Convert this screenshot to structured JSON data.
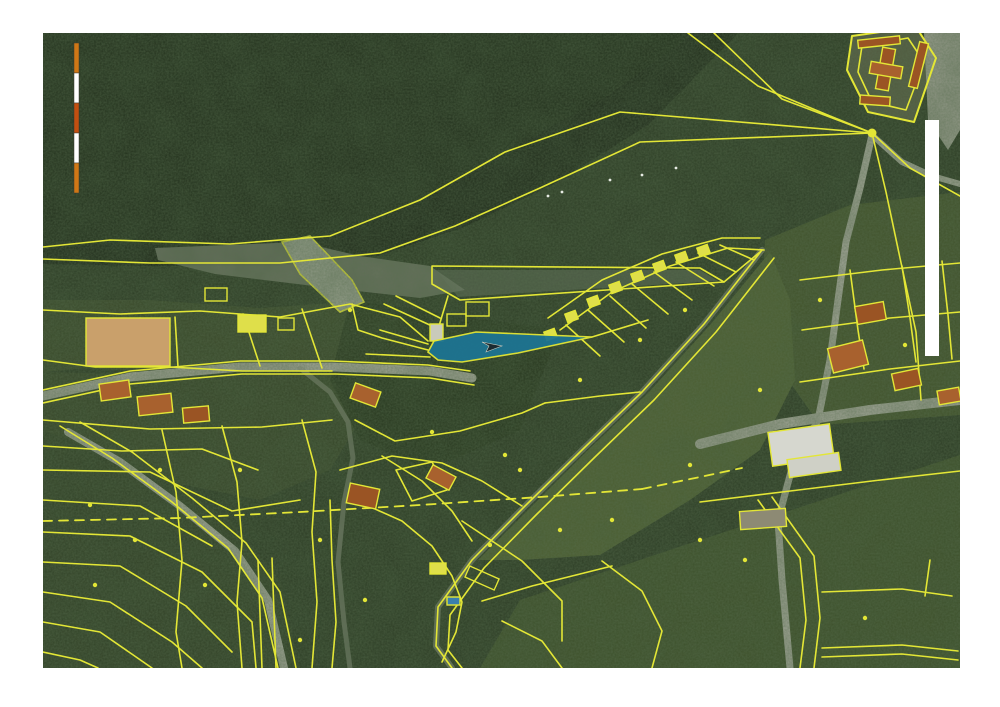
{
  "document": {
    "kind": "scanned cadastral orthophoto map page",
    "page_background": "#ffffff",
    "map_bounds": {
      "x": 43,
      "y": 33,
      "width": 917,
      "height": 635
    }
  },
  "palette": {
    "parcel_line_yellow": "#e3e636",
    "building_yellow": "#dfdf4a",
    "roof_orange": "#a8612e",
    "roof_dark_orange": "#9a5424",
    "tan_field": "#c9a06b",
    "road_gray": "#a5a89a",
    "river_dark": "#1d2818",
    "forest_dark": "#202d1a",
    "forest_base": "#2b3a23",
    "clearing_green": "#3a4929",
    "meadow_bright": "#4d5f31",
    "meadow_mid": "#41522a",
    "gravel_gray": "#7c8471",
    "highlight_blue": "#1d7492",
    "scale_orange": "#cf7716",
    "scale_red_orange": "#c34f10",
    "white": "#ffffff"
  },
  "scale_bar": {
    "x": 74,
    "y": 43,
    "segment_width": 5,
    "segment_height": 30,
    "segment_colors": [
      "#cf7716",
      "#ffffff",
      "#c34f10",
      "#ffffff",
      "#cf7716"
    ]
  },
  "white_bar": {
    "x": 925,
    "y": 120,
    "width": 14,
    "height": 236
  },
  "highlight_parcel": {
    "points": "428,352 434,341 476,332 592,337 518,353 462,362 438,360",
    "fill": "#1d7492",
    "opacity": 0.95,
    "stroke": "#e3e636",
    "marker_points": "482,342 502,346 486,352 489,346",
    "marker_fill": "#1b2a30",
    "marker_stroke": "#cfd0c2"
  },
  "areas": [
    {
      "n": "forest-base",
      "p": "43,33 960,33 960,668 43,668",
      "f": "#2b3a23"
    },
    {
      "n": "forest-dark-north",
      "p": "43,33 695,33 600,100 500,155 410,205 320,240 200,250 100,246 43,250",
      "f": "#202d1a"
    },
    {
      "n": "river",
      "p": "695,33 738,33 648,125 552,185 462,228 378,256 280,266 150,266 43,264 43,250 110,243 210,247 320,238 415,202 505,152 605,97",
      "f": "#1d2818"
    },
    {
      "n": "gravel-bar",
      "p": "155,248 300,242 360,256 430,266 465,290 420,298 330,288 215,274 158,260",
      "f": "#7c8471",
      "o": 0.75
    },
    {
      "n": "gravel-spit",
      "p": "436,270 700,270 718,281 458,297",
      "f": "#6e7a68",
      "o": 0.5
    },
    {
      "n": "meadow-upper-right",
      "p": "765,240 850,205 960,192 960,415 820,425 760,340",
      "f": "#41522a"
    },
    {
      "n": "meadow-center",
      "p": "770,252 790,300 795,380 760,450 690,500 600,555 520,560 478,560 530,508 588,450 648,393 710,325",
      "f": "#4d5f31"
    },
    {
      "n": "meadow-bottom-right",
      "p": "520,600 700,540 960,455 960,668 480,668",
      "f": "#3d4f29"
    },
    {
      "n": "clearing-village",
      "p": "43,300 150,300 260,308 350,302 400,318 428,345 400,370 330,368 240,372 150,372 90,368 43,372",
      "f": "#3a4929",
      "o": 0.9
    },
    {
      "n": "clearing-village-south",
      "p": "43,372 200,376 330,374 360,420 330,470 260,500 160,480 80,445 43,430",
      "f": "#384728",
      "o": 0.8
    },
    {
      "n": "residential-bottom-left",
      "p": "43,430 150,470 230,520 280,580 300,668 43,668",
      "f": "#334226",
      "o": 0.7
    },
    {
      "n": "dark-woods-center",
      "p": "350,300 560,330 520,430 430,470 360,440 330,380",
      "f": "#243219",
      "o": 0.7
    },
    {
      "n": "castle-grounds",
      "p": "852,36 916,27 936,58 914,122 868,112 847,70",
      "f": "#5a5f46",
      "o": 0.9
    },
    {
      "n": "parking-top-right",
      "p": "924,33 960,33 960,130 948,150 928,120",
      "f": "#a5a89a",
      "o": 0.9
    },
    {
      "n": "weir-structure",
      "p": "282,242 310,236 352,280 364,302 340,312 300,274",
      "f": "#98a08e",
      "o": 1,
      "s": "#e3e636"
    }
  ],
  "roads": [
    {
      "n": "road-village",
      "p": "43,396 130,377 240,367 335,367 430,371 472,378",
      "w": 9,
      "c": "#a5a89a"
    },
    {
      "n": "road-bottom-left",
      "p": "68,432 120,462 180,506 235,551 268,600 284,668",
      "w": 8,
      "c": "#a5a89a"
    },
    {
      "n": "road-long-diagonal",
      "p": "762,250 704,324 642,392 582,450 524,507 472,560 438,607 436,646 452,668",
      "w": 6,
      "c": "#737c66",
      "o": 0.9
    },
    {
      "n": "road-right-vertical",
      "p": "872,135 860,188 846,242 838,300 830,360 818,420 792,468 778,520 782,580 790,668",
      "w": 7,
      "c": "#a5a89a"
    },
    {
      "n": "road-right-horizontal",
      "p": "700,444 780,424 870,410 960,400",
      "w": 10,
      "c": "#a5a89a"
    },
    {
      "n": "road-castle-south",
      "p": "872,135 902,162 932,176 960,184",
      "w": 6,
      "c": "#a5a89a"
    },
    {
      "n": "road-center-lane",
      "p": "300,368 330,392 348,422 353,458 344,502 338,562 344,622 350,668",
      "w": 5,
      "c": "#8d9282",
      "o": 0.6
    }
  ],
  "lines": [
    {
      "n": "river-bank-upper",
      "p": "872,133 620,112 505,152 420,200 330,236 230,244 110,240 43,247"
    },
    {
      "n": "river-bank-lower",
      "p": "872,133 640,142 540,188 455,226 380,253 280,263 150,263 43,259"
    },
    {
      "n": "fan-line-a",
      "p": "688,33 758,86 830,116 872,133"
    },
    {
      "n": "fan-line-b",
      "p": "714,33 782,99 872,133"
    },
    {
      "n": "fan-line-c",
      "p": "872,133 910,168 960,196"
    },
    {
      "n": "fan-line-d",
      "p": "872,133 886,192 900,258 916,332 921,400"
    },
    {
      "n": "gravel-spit-outline",
      "p": "432,266 700,268 724,282 460,300 432,284",
      "closed": true
    },
    {
      "n": "spit-to-strip",
      "p": "724,282 760,252"
    },
    {
      "n": "road-diag-edge-a",
      "p": "762,250 704,324 642,392 582,450 524,507 472,560 438,607 436,646 452,668"
    },
    {
      "n": "road-diag-edge-b",
      "p": "774,258 716,332 654,400 594,458 536,515 484,568 450,615 448,650 462,668"
    },
    {
      "n": "strip-outer-a",
      "p": "548,318 602,280 662,254 722,238 760,238"
    },
    {
      "n": "strip-outer-b",
      "p": "560,330 612,292 670,266 728,248 764,250"
    },
    {
      "n": "lot-tie-1",
      "p": "566,325 600,356"
    },
    {
      "n": "lot-tie-2",
      "p": "588,310 624,342"
    },
    {
      "n": "lot-tie-3",
      "p": "610,296 646,328"
    },
    {
      "n": "lot-tie-4",
      "p": "632,284 668,314"
    },
    {
      "n": "lot-tie-5",
      "p": "654,272 692,300"
    },
    {
      "n": "lot-tie-6",
      "p": "676,262 714,286"
    },
    {
      "n": "lot-tie-7",
      "p": "698,253 736,272"
    },
    {
      "n": "lot-tie-8",
      "p": "720,245 754,260"
    },
    {
      "n": "village-line-1",
      "p": "43,310 120,314 200,311 280,317 350,304 400,317 428,341"
    },
    {
      "n": "village-line-2",
      "p": "175,317 178,367"
    },
    {
      "n": "village-line-3",
      "p": "243,314 260,366"
    },
    {
      "n": "village-line-4",
      "p": "302,309 322,368"
    },
    {
      "n": "village-line-5",
      "p": "352,304 358,330 382,338 428,350"
    },
    {
      "n": "village-line-6",
      "p": "43,360 95,367 170,367 242,371 332,371"
    },
    {
      "n": "road-village-edge-a",
      "p": "43,390 130,371 240,361 332,361 428,365 470,371"
    },
    {
      "n": "road-village-edge-b",
      "p": "43,403 130,384 242,374 336,374 430,378 474,385"
    },
    {
      "n": "village-line-7",
      "p": "43,420 150,429 262,427 332,420"
    },
    {
      "n": "village-line-8",
      "p": "43,446 122,451 202,449 258,470"
    },
    {
      "n": "road-bl-edge-a",
      "p": "60,426 112,458 172,502 228,548 262,598 278,668"
    },
    {
      "n": "road-bl-edge-b",
      "p": "80,422 132,452 192,498 246,543 280,592 296,668"
    },
    {
      "n": "cross-street-1",
      "p": "43,470 150,472 232,511 300,500"
    },
    {
      "n": "cross-street-2",
      "p": "43,500 140,506 212,546"
    },
    {
      "n": "cross-street-3",
      "p": "43,532 130,536 202,572 252,622 256,668"
    },
    {
      "n": "cross-street-4",
      "p": "43,562 120,566 186,606 232,652"
    },
    {
      "n": "cross-street-5",
      "p": "43,592 110,602 172,642 202,668"
    },
    {
      "n": "cross-street-6",
      "p": "43,622 100,632 152,668"
    },
    {
      "n": "cross-street-7",
      "p": "43,652 80,660 98,668"
    },
    {
      "n": "long-lot-1",
      "p": "162,430 176,492 182,560 176,632 182,668"
    },
    {
      "n": "long-lot-2",
      "p": "222,426 237,482 242,542 237,602 242,668"
    },
    {
      "n": "long-lot-3",
      "p": "302,420 316,472 312,532 317,602 312,668"
    },
    {
      "n": "narrow-lot-a",
      "p": "258,560 262,668"
    },
    {
      "n": "narrow-lot-b",
      "p": "272,558 276,668"
    },
    {
      "n": "long-lot-4",
      "p": "330,500 332,560 336,622 332,668"
    },
    {
      "n": "center-line-1",
      "p": "355,420 395,441 460,431 522,413 545,403"
    },
    {
      "n": "center-line-2",
      "p": "545,403 600,396 640,392"
    },
    {
      "n": "center-line-3",
      "p": "340,470 392,456 442,463 482,481 522,506"
    },
    {
      "n": "center-line-4",
      "p": "355,500 402,521 432,546 452,576 462,602 456,632 442,662"
    },
    {
      "n": "center-line-5",
      "p": "382,456 422,481 452,511 472,541"
    },
    {
      "n": "center-parcel",
      "p": "396,470 432,462 447,490 412,501",
      "closed": true
    },
    {
      "n": "center-line-6",
      "p": "462,521 522,561 562,601 562,641"
    },
    {
      "n": "center-line-7",
      "p": "482,601 532,586 572,576 612,566"
    },
    {
      "n": "center-line-8",
      "p": "502,621 542,641 562,668"
    },
    {
      "n": "center-line-9",
      "p": "602,561 642,591 662,631 652,668"
    },
    {
      "n": "right-grid-1",
      "p": "800,280 882,270 960,263"
    },
    {
      "n": "right-grid-2",
      "p": "802,330 890,318 960,312"
    },
    {
      "n": "right-grid-3",
      "p": "800,382 890,369 960,361"
    },
    {
      "n": "right-grid-4",
      "p": "850,270 858,330 864,369"
    },
    {
      "n": "right-grid-5",
      "p": "902,266 910,318 916,362"
    },
    {
      "n": "right-grid-6",
      "p": "942,261 948,315 952,359"
    },
    {
      "n": "right-line-1",
      "p": "700,502 782,492 872,481 960,471"
    },
    {
      "n": "right-line-2",
      "p": "822,592 902,589 952,596"
    },
    {
      "n": "right-line-3",
      "p": "822,648 902,645 958,651"
    },
    {
      "n": "right-line-4",
      "p": "822,657 902,654 958,660"
    },
    {
      "n": "right-line-5",
      "p": "930,560 925,596"
    },
    {
      "n": "road-rb-edge-a",
      "p": "758,500 800,558 806,620 800,668"
    },
    {
      "n": "road-rb-edge-b",
      "p": "772,497 814,556 820,618 814,668"
    },
    {
      "n": "castle-wall-outer",
      "p": "852,36 916,27 936,58 914,122 868,112 847,70",
      "closed": true,
      "w": 2
    },
    {
      "n": "castle-wall-inner",
      "p": "862,46 908,38 924,62 906,110 872,102 858,72",
      "closed": true
    },
    {
      "n": "field-divider",
      "p": "140,318 142,366"
    },
    {
      "n": "blue-parcel-line-a",
      "p": "380,330 428,344"
    },
    {
      "n": "blue-parcel-line-b",
      "p": "366,354 430,357"
    },
    {
      "n": "blue-parcel-tip-line",
      "p": "592,337 648,320"
    },
    {
      "n": "blue-access-road-a",
      "p": "384,304 432,326"
    },
    {
      "n": "blue-access-road-b",
      "p": "396,296 440,318"
    },
    {
      "n": "spit-connector",
      "p": "448,296 436,336"
    }
  ],
  "dashed_lines": [
    {
      "n": "dashed-boundary-west",
      "p": "43,521 180,518 300,512 420,505 540,497 642,489"
    },
    {
      "n": "dashed-boundary-east",
      "p": "642,489 700,477 742,468"
    }
  ],
  "buildings": [
    {
      "n": "tan-field",
      "x": 86,
      "y": 318,
      "w": 84,
      "h": 48,
      "r": 0,
      "f": "#c9a06b"
    },
    {
      "n": "yellow-building-1",
      "x": 238,
      "y": 315,
      "w": 28,
      "h": 17,
      "r": 0,
      "f": "#dfdf4a"
    },
    {
      "n": "outline-building-1",
      "x": 278,
      "y": 318,
      "w": 16,
      "h": 12,
      "r": 0,
      "f": "none"
    },
    {
      "n": "roof-house-1",
      "x": 100,
      "y": 382,
      "w": 30,
      "h": 17,
      "r": -8,
      "f": "#a8612e"
    },
    {
      "n": "roof-house-2",
      "x": 138,
      "y": 395,
      "w": 34,
      "h": 19,
      "r": -6,
      "f": "#a8612e"
    },
    {
      "n": "roof-house-3",
      "x": 183,
      "y": 407,
      "w": 26,
      "h": 15,
      "r": -5,
      "f": "#9a5424"
    },
    {
      "n": "roof-house-4",
      "x": 352,
      "y": 387,
      "w": 27,
      "h": 16,
      "r": 20,
      "f": "#a8612e"
    },
    {
      "n": "roof-house-5",
      "x": 348,
      "y": 486,
      "w": 30,
      "h": 20,
      "r": 12,
      "f": "#9a5424"
    },
    {
      "n": "roof-house-6",
      "x": 428,
      "y": 470,
      "w": 26,
      "h": 15,
      "r": 28,
      "f": "#a8612e"
    },
    {
      "n": "roof-house-7",
      "x": 856,
      "y": 304,
      "w": 29,
      "h": 18,
      "r": -10,
      "f": "#9a5424"
    },
    {
      "n": "roof-house-8",
      "x": 830,
      "y": 344,
      "w": 36,
      "h": 25,
      "r": -14,
      "f": "#a8612e"
    },
    {
      "n": "roof-house-9",
      "x": 893,
      "y": 371,
      "w": 27,
      "h": 17,
      "r": -12,
      "f": "#9a5424"
    },
    {
      "n": "roof-house-10",
      "x": 938,
      "y": 389,
      "w": 22,
      "h": 14,
      "r": -10,
      "f": "#a8612e"
    },
    {
      "n": "castle-roof-1",
      "x": 879,
      "y": 48,
      "w": 13,
      "h": 42,
      "r": 10,
      "f": "#9a5424"
    },
    {
      "n": "castle-roof-2",
      "x": 870,
      "y": 64,
      "w": 32,
      "h": 12,
      "r": 10,
      "f": "#a8612e"
    },
    {
      "n": "castle-roof-3",
      "x": 858,
      "y": 38,
      "w": 42,
      "h": 8,
      "r": -6,
      "f": "#9a5424"
    },
    {
      "n": "castle-roof-4",
      "x": 914,
      "y": 42,
      "w": 9,
      "h": 46,
      "r": 14,
      "f": "#9a5424"
    },
    {
      "n": "castle-roof-5",
      "x": 860,
      "y": 96,
      "w": 30,
      "h": 9,
      "r": 4,
      "f": "#9a5424"
    },
    {
      "n": "strip-cabin-1",
      "x": 566,
      "y": 312,
      "w": 11,
      "h": 9,
      "r": -20,
      "f": "#dfdf4a"
    },
    {
      "n": "strip-cabin-2",
      "x": 588,
      "y": 297,
      "w": 11,
      "h": 9,
      "r": -20,
      "f": "#dfdf4a"
    },
    {
      "n": "strip-cabin-3",
      "x": 610,
      "y": 283,
      "w": 11,
      "h": 9,
      "r": -20,
      "f": "#dfdf4a"
    },
    {
      "n": "strip-cabin-4",
      "x": 632,
      "y": 272,
      "w": 11,
      "h": 9,
      "r": -20,
      "f": "#dfdf4a"
    },
    {
      "n": "strip-cabin-5",
      "x": 654,
      "y": 262,
      "w": 11,
      "h": 9,
      "r": -20,
      "f": "#dfdf4a"
    },
    {
      "n": "strip-cabin-6",
      "x": 676,
      "y": 253,
      "w": 11,
      "h": 9,
      "r": -20,
      "f": "#dfdf4a"
    },
    {
      "n": "strip-cabin-7",
      "x": 698,
      "y": 246,
      "w": 11,
      "h": 9,
      "r": -20,
      "f": "#dfdf4a"
    },
    {
      "n": "strip-cabin-8",
      "x": 545,
      "y": 330,
      "w": 11,
      "h": 9,
      "r": -20,
      "f": "#dfdf4a"
    },
    {
      "n": "yellow-building-2",
      "x": 430,
      "y": 563,
      "w": 16,
      "h": 11,
      "r": 0,
      "f": "#dfdf4a"
    },
    {
      "n": "outline-building-2",
      "x": 466,
      "y": 572,
      "w": 32,
      "h": 12,
      "r": 24,
      "f": "none"
    },
    {
      "n": "outline-building-3",
      "x": 205,
      "y": 288,
      "w": 22,
      "h": 13,
      "r": 0,
      "f": "none"
    },
    {
      "n": "parcel-house-blue-1",
      "x": 430,
      "y": 324,
      "w": 13,
      "h": 17,
      "r": 0,
      "f": "#c9cabb"
    },
    {
      "n": "parcel-house-blue-2",
      "x": 447,
      "y": 314,
      "w": 19,
      "h": 12,
      "r": 0,
      "f": "none"
    },
    {
      "n": "parcel-house-blue-3",
      "x": 466,
      "y": 302,
      "w": 23,
      "h": 14,
      "r": 0,
      "f": "none"
    },
    {
      "n": "swimming-pool",
      "x": 447,
      "y": 597,
      "w": 13,
      "h": 8,
      "r": 0,
      "f": "#3a7fae"
    },
    {
      "n": "white-building-1",
      "x": 770,
      "y": 428,
      "w": 62,
      "h": 34,
      "r": -8,
      "f": "#d6d7cf"
    },
    {
      "n": "white-building-2",
      "x": 788,
      "y": 456,
      "w": 52,
      "h": 18,
      "r": -8,
      "f": "#cfd0c6"
    },
    {
      "n": "barn-bottom-right",
      "x": 740,
      "y": 510,
      "w": 46,
      "h": 18,
      "r": -4,
      "f": "#8d8a74"
    }
  ],
  "yellow_dots": [
    [
      872,
      133
    ],
    [
      320,
      540
    ],
    [
      365,
      600
    ],
    [
      300,
      640
    ],
    [
      135,
      540
    ],
    [
      95,
      585
    ],
    [
      205,
      585
    ],
    [
      432,
      432
    ],
    [
      505,
      455
    ],
    [
      560,
      530
    ],
    [
      612,
      520
    ],
    [
      700,
      540
    ],
    [
      865,
      618
    ],
    [
      820,
      300
    ],
    [
      905,
      345
    ],
    [
      760,
      390
    ],
    [
      640,
      340
    ],
    [
      685,
      310
    ],
    [
      580,
      380
    ],
    [
      490,
      545
    ],
    [
      240,
      470
    ],
    [
      160,
      470
    ],
    [
      90,
      505
    ],
    [
      690,
      465
    ],
    [
      745,
      560
    ],
    [
      350,
      310
    ],
    [
      520,
      470
    ]
  ],
  "white_specks": [
    [
      548,
      196
    ],
    [
      562,
      192
    ],
    [
      610,
      180
    ],
    [
      642,
      175
    ],
    [
      676,
      168
    ]
  ]
}
